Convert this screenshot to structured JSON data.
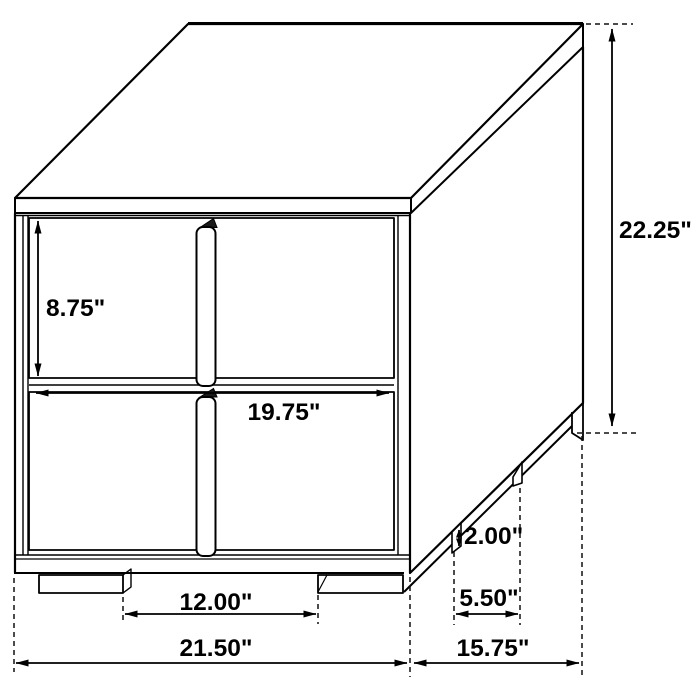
{
  "figure": {
    "background_color": "#ffffff",
    "line_color": "#000000"
  },
  "dimensions": {
    "overall_height": {
      "label": "22.25\"",
      "value": 22.25,
      "unit": "inches"
    },
    "overall_width": {
      "label": "21.50\"",
      "value": 21.5,
      "unit": "inches"
    },
    "overall_depth": {
      "label": "15.75\"",
      "value": 15.75,
      "unit": "inches"
    },
    "drawer_front_height": {
      "label": "8.75\"",
      "value": 8.75,
      "unit": "inches"
    },
    "drawer_front_width": {
      "label": "19.75\"",
      "value": 19.75,
      "unit": "inches"
    },
    "foot_height": {
      "label": "2.00\"",
      "value": 2.0,
      "unit": "inches"
    },
    "side_foot_spacing": {
      "label": "5.50\"",
      "value": 5.5,
      "unit": "inches"
    },
    "front_foot_spacing": {
      "label": "12.00\"",
      "value": 12.0,
      "unit": "inches"
    }
  }
}
